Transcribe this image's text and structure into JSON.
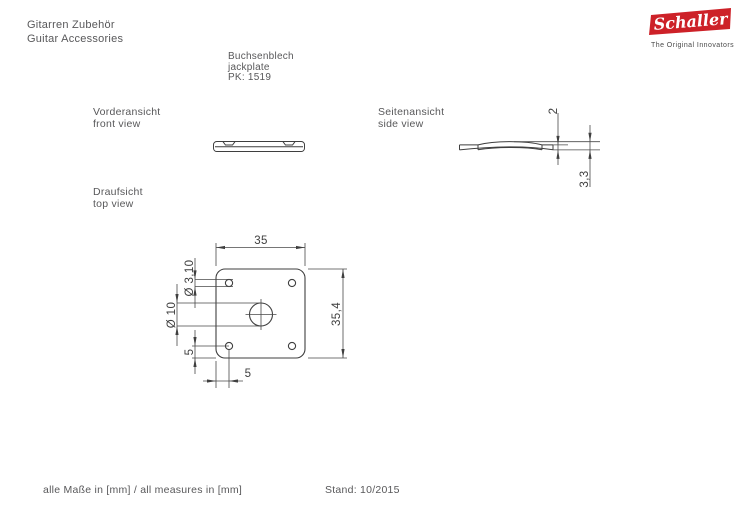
{
  "header": {
    "title_de": "Gitarren Zubehör",
    "title_en": "Guitar Accessories"
  },
  "part": {
    "name_de": "Buchsenblech",
    "name_en": "jackplate",
    "number": "PK: 1519"
  },
  "logo": {
    "brand": "Schaller",
    "tagline": "The Original Innovators",
    "bg_color": "#cd2128"
  },
  "views": {
    "front": {
      "label_de": "Vorderansicht",
      "label_en": "front view"
    },
    "side": {
      "label_de": "Seitenansicht",
      "label_en": "side view"
    },
    "top": {
      "label_de": "Draufsicht",
      "label_en": "top view"
    }
  },
  "dims": {
    "top_width": "35",
    "top_height": "35,4",
    "screw_hole_dia": "Ø 3,10",
    "center_hole_dia": "Ø 10",
    "offset_vertical": "5",
    "offset_horizontal": "5",
    "side_thickness": "2",
    "side_total_height": "3,3"
  },
  "drawing": {
    "line_color": "#3f3f3f"
  },
  "footer": {
    "units_note": "alle Maße in [mm] / all measures in [mm]",
    "date": "Stand: 10/2015"
  }
}
